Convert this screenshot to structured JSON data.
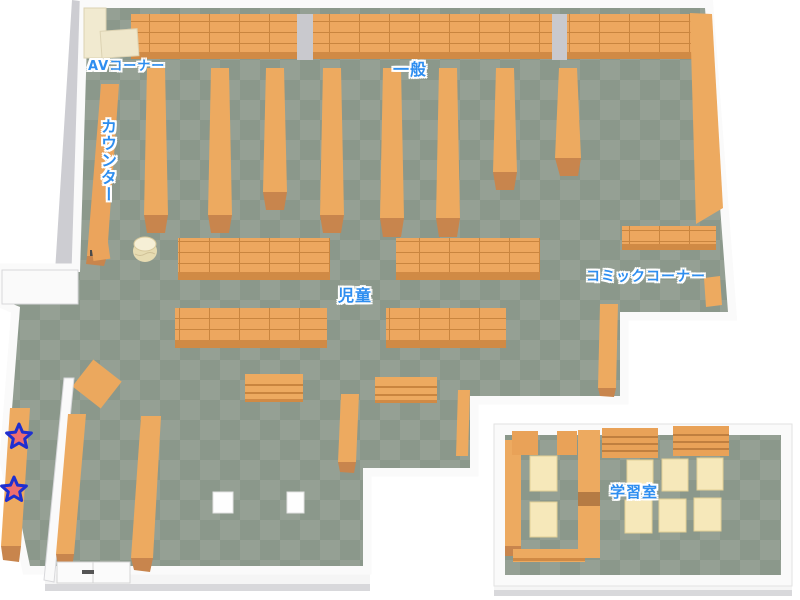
{
  "map": {
    "labels": {
      "av_corner": "AVコーナー",
      "general": "一般",
      "counter": "カウンター",
      "children": "児童",
      "comic_corner": "コミックコーナー",
      "study_room": "学習室"
    },
    "markers": [
      {
        "name": "star-marker-upper",
        "shape": "star"
      },
      {
        "name": "star-marker-lower",
        "shape": "star"
      }
    ],
    "colors": {
      "label_text": "#2e8ef0",
      "label_outline": "#ffffff",
      "floor_light": "#95a094",
      "floor_dark": "#8b988b",
      "shelf_orange": "#edaa60",
      "shelf_line": "#c9853f",
      "shelf_cap": "#c8854d",
      "cream_furniture": "#f1ead0",
      "table_cream": "#f6e8ba",
      "wall_white": "#fafafa",
      "wall_gray": "#cdcdd2",
      "star_fill": "#ef6f6f",
      "star_border": "#1f2fd0"
    }
  }
}
